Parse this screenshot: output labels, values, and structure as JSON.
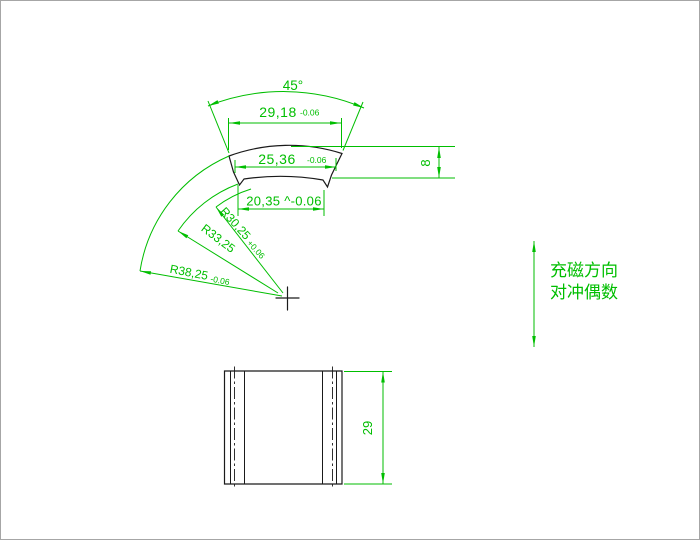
{
  "drawing": {
    "type_note": "CAD drawing of an arc (tile) magnet segment, front view and side view",
    "colors": {
      "dimension_green": "#00be00",
      "geometry_black": "#1a1a1a",
      "background": "#ffffff",
      "border": "#a6a6a6"
    },
    "front_view": {
      "angle_dim": "45°",
      "outer_chord": {
        "value": "29,18",
        "tol": "-0.06"
      },
      "mid_chord": {
        "value": "25,36",
        "tol": "-0.06"
      },
      "inner_chord": {
        "value": "20,35 ^-0.06"
      },
      "thickness_dim": "8",
      "radius_inner": {
        "value": "R30,25",
        "tol": "+0.06"
      },
      "radius_mid": {
        "value": "R33,25"
      },
      "radius_outer": {
        "value": "R38,25",
        "tol": "-0.06"
      }
    },
    "side_view": {
      "height_dim": "29"
    },
    "annotation": {
      "line1": "充磁方向",
      "line2": "对冲偶数"
    }
  }
}
